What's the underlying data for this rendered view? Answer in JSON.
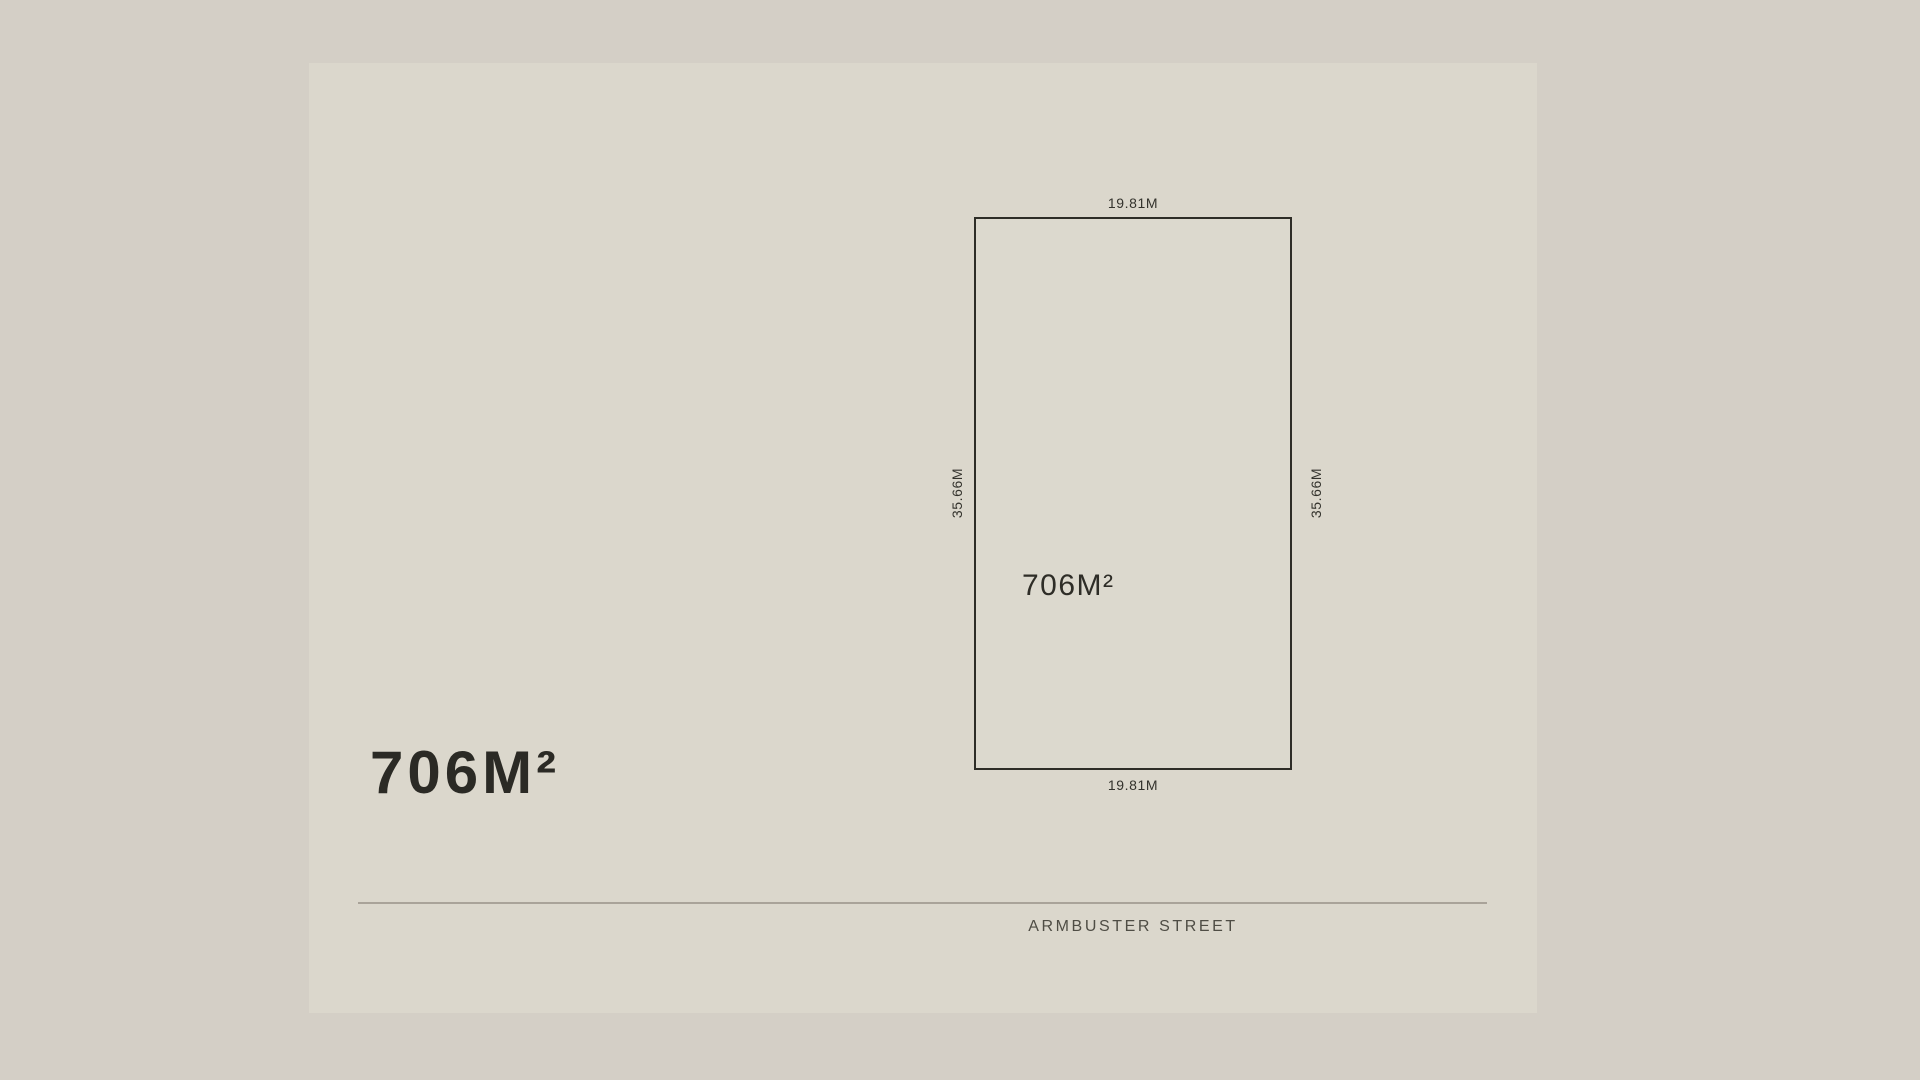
{
  "canvas": {
    "colors": {
      "background": "#d4cfc6",
      "panel": "#dbd7cc",
      "boundary_ink": "#2e2d27",
      "headline_ink": "#2b2a25",
      "dimension_ink": "#33322c",
      "street_ink": "#4f4d45",
      "divider": "#a9a399"
    }
  },
  "lot_plan": {
    "headline_area": "706M²",
    "lot": {
      "area": "706M²",
      "dimensions": {
        "top": "19.81M",
        "bottom": "19.81M",
        "left": "35.66M",
        "right": "35.66M"
      }
    },
    "street": "ARMBUSTER STREET"
  }
}
